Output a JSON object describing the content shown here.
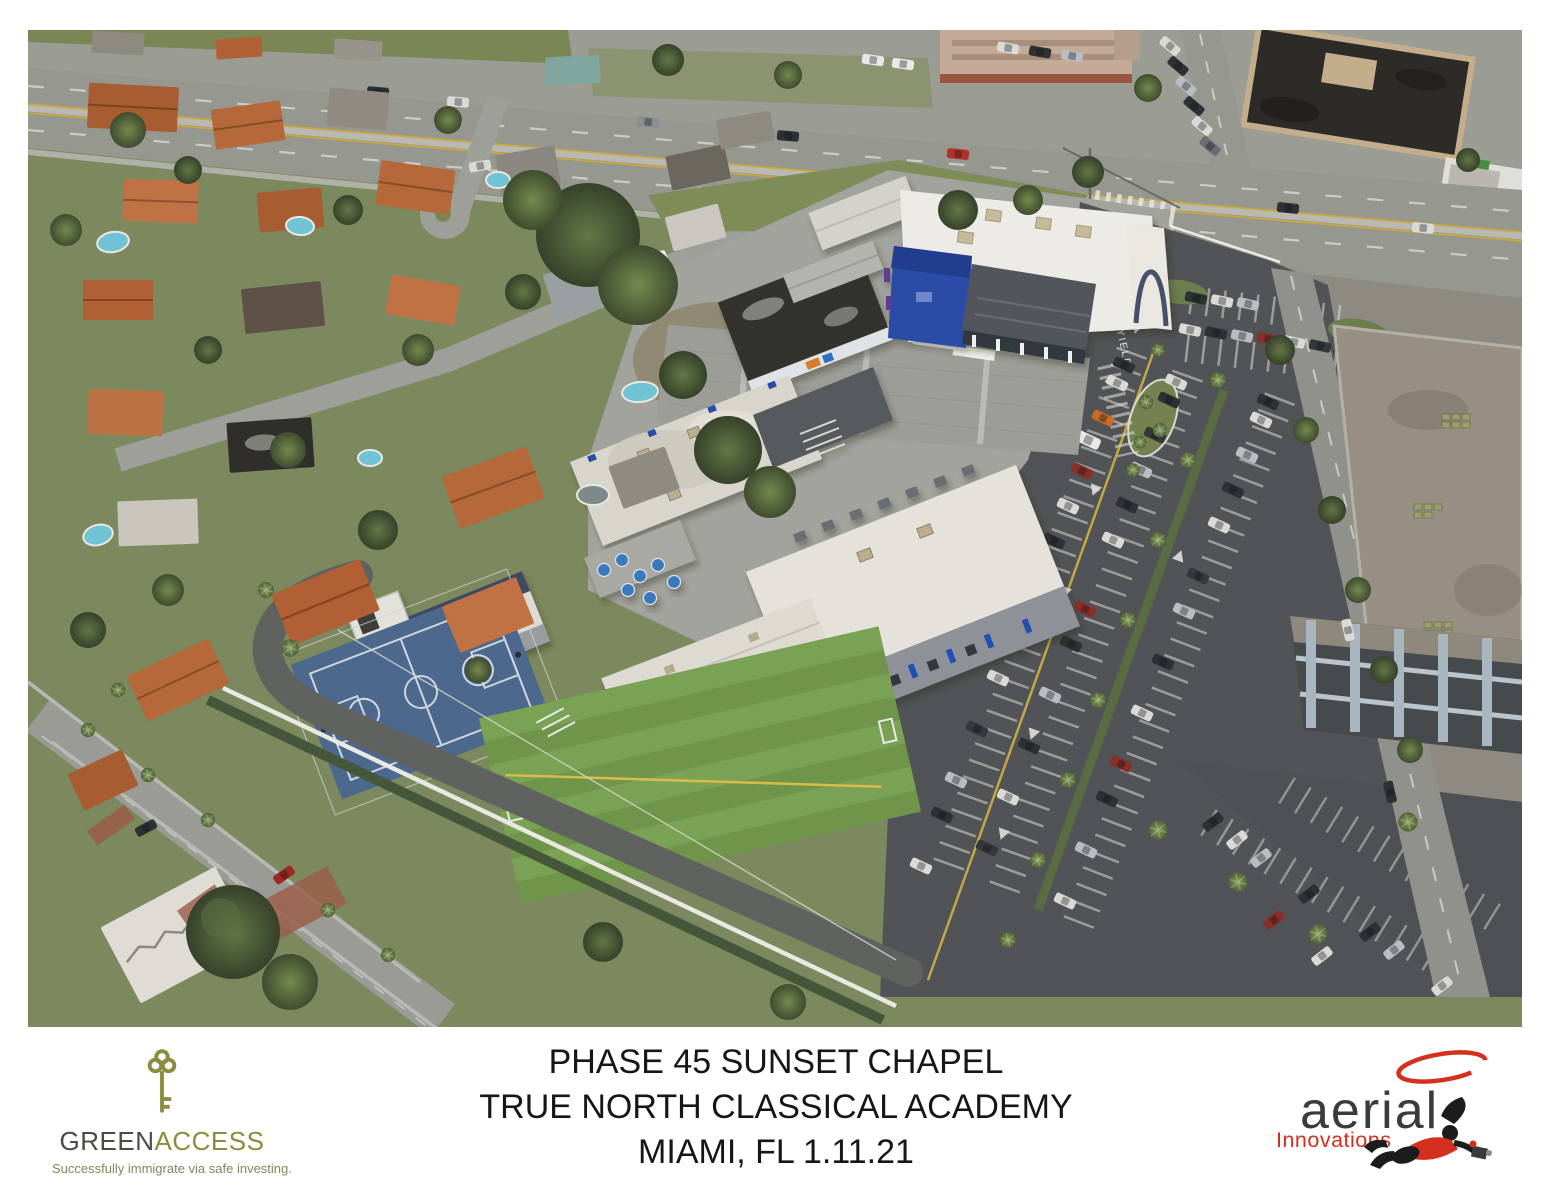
{
  "photo": {
    "alt": "Oblique aerial photograph of a school campus: white classroom buildings with a royal-blue entry tower and dark metal canopy, paver courtyard, blue basketball court, green turf field with portable classroom, full parking lots with tree islands, a highway along the top, residential neighborhood with terracotta roofs and pools on the left, and industrial roofs with a parking garage on the right",
    "pavement_marking": "YIELD",
    "colors": {
      "school_blue": "#2b4ba6",
      "court_blue": "#4c688c",
      "turf_green": "#6e9549",
      "roof_white": "#e4e2da",
      "asphalt": "#515356"
    }
  },
  "footer": {
    "greenaccess": {
      "name_part1": "GREEN",
      "name_part2": "ACCESS",
      "tagline": "Successfully immigrate via safe investing.",
      "olive": "#8a8c3e",
      "charcoal": "#4b4b46"
    },
    "caption": {
      "line1": "PHASE 45 SUNSET CHAPEL",
      "line2": "TRUE NORTH CLASSICAL ACADEMY",
      "line3": "MIAMI, FL 1.11.21"
    },
    "aerial": {
      "word1": "aerial",
      "word2": "Innovations",
      "red": "#d4301e",
      "dark": "#3b3b3d"
    }
  }
}
